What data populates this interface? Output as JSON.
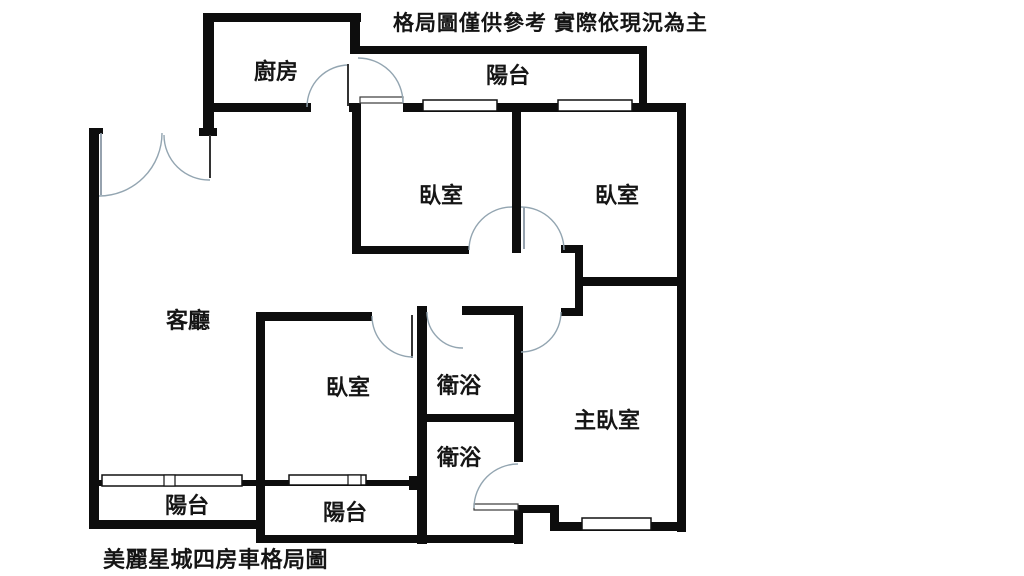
{
  "meta": {
    "disclaimer": "格局圖僅供參考 實際依現況為主",
    "caption": "美麗星城四房車格局圖"
  },
  "rooms": {
    "kitchen": {
      "label": "廚房"
    },
    "balcony_top": {
      "label": "陽台"
    },
    "bedroom_1": {
      "label": "臥室"
    },
    "bedroom_2": {
      "label": "臥室"
    },
    "living_room": {
      "label": "客廳"
    },
    "bedroom_3": {
      "label": "臥室"
    },
    "bathroom_1": {
      "label": "衛浴"
    },
    "bathroom_2": {
      "label": "衛浴"
    },
    "master_bedroom": {
      "label": "主臥室"
    },
    "balcony_bottom_left": {
      "label": "陽台"
    },
    "balcony_bottom_center": {
      "label": "陽台"
    }
  },
  "colors": {
    "background": "#ffffff",
    "wall": "#0d0d0d",
    "door_arc": "#93a5b1",
    "text": "#151515"
  }
}
